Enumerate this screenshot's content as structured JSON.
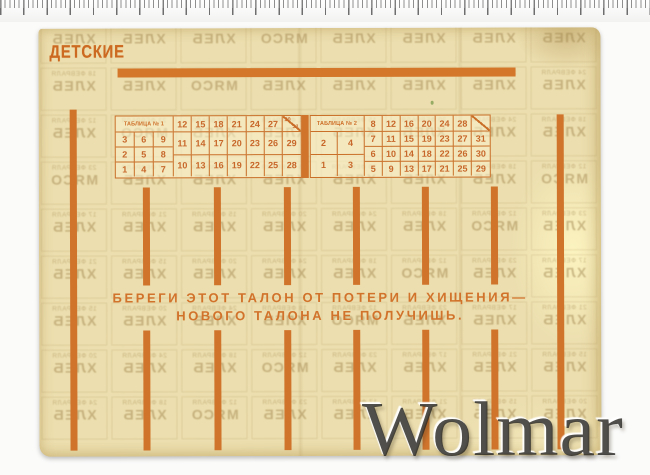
{
  "card": {
    "title": "ДЕТСКИЕ",
    "slogan": {
      "line1": "БЕРЕГИ ЭТОТ ТАЛОН ОТ ПОТЕРИ И ХИЩЕНИЯ—",
      "line2": "НОВОГО ТАЛОНА НЕ ПОЛУЧИШЬ."
    },
    "colors": {
      "paper": "#ecdeae",
      "ink_orange": "#d0742c",
      "ghost_print": "#a0854e"
    },
    "tables": [
      {
        "header": "ТАБЛИЦА № 1",
        "left_grid": [
          [
            "3",
            "6",
            "9"
          ],
          [
            "2",
            "5",
            "8"
          ],
          [
            "1",
            "4",
            "7"
          ]
        ],
        "first_row": [
          "12",
          "15",
          "18",
          "21",
          "24",
          "27"
        ],
        "split_cell": {
          "top": "30",
          "bottom": "31"
        },
        "rows": [
          [
            "11",
            "14",
            "17",
            "20",
            "23",
            "26",
            "29"
          ],
          [
            "10",
            "13",
            "16",
            "19",
            "22",
            "25",
            "28"
          ]
        ]
      },
      {
        "header": "ТАБЛИЦА № 2",
        "left_grid": [
          [
            "2",
            "4"
          ],
          [
            "1",
            "3"
          ]
        ],
        "first_row": [
          "8",
          "12",
          "16",
          "20",
          "24",
          "28"
        ],
        "split_cell": {
          "top": "",
          "bottom": ""
        },
        "rows": [
          [
            "7",
            "11",
            "15",
            "19",
            "23",
            "27",
            "31"
          ],
          [
            "6",
            "10",
            "14",
            "18",
            "22",
            "26",
            "30"
          ],
          [
            "5",
            "9",
            "13",
            "17",
            "21",
            "25",
            "29"
          ]
        ]
      }
    ],
    "ghost_print": {
      "day_numbers": [
        "24",
        "18",
        "12",
        "23",
        "17",
        "21",
        "15",
        "20"
      ],
      "month": "ФЕВРАЛЯ",
      "products": [
        "ХЛЕБ",
        "МЯСО"
      ]
    }
  },
  "watermark": {
    "text": "Wolmar"
  }
}
